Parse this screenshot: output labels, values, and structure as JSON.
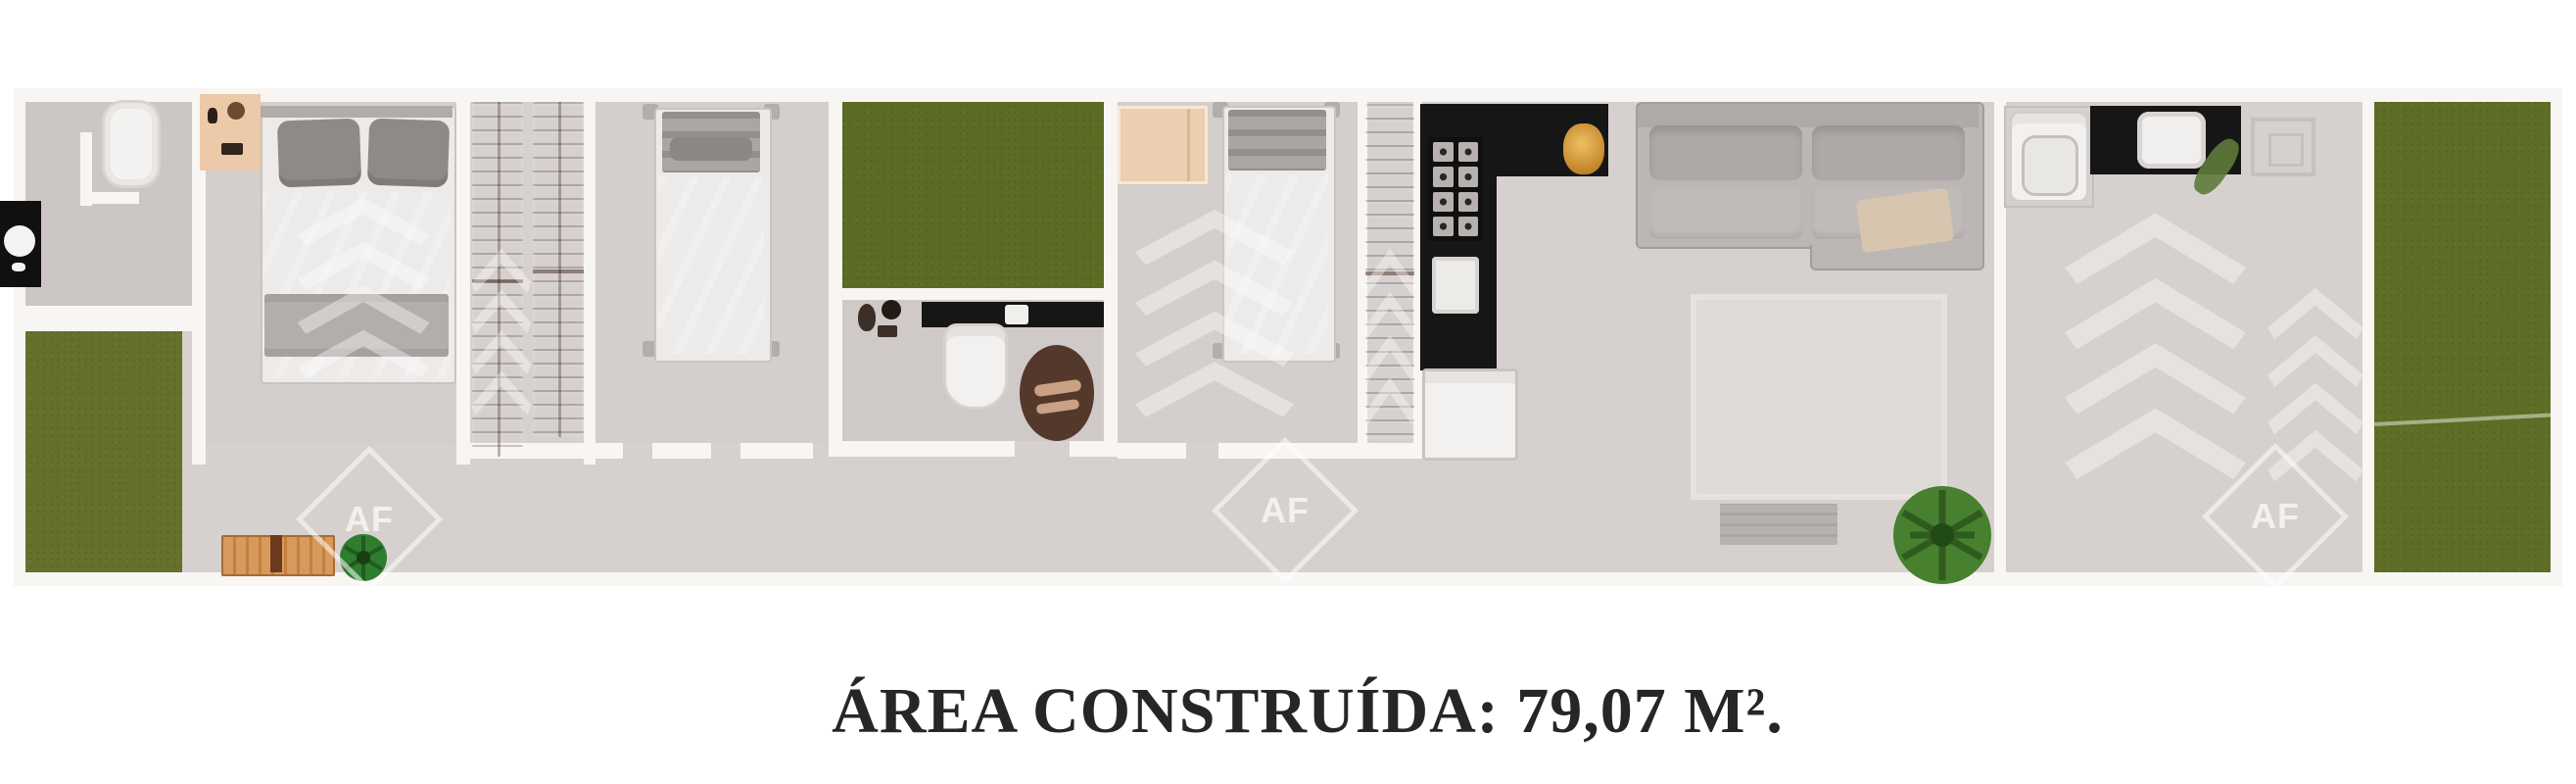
{
  "caption": {
    "text": "ÁREA CONSTRUÍDA: 79,07 M²."
  },
  "watermark": {
    "initials": "AF"
  },
  "colors": {
    "page_bg": "#ffffff",
    "floor": "#d6d1ce",
    "floor_dark": "#ccc7c4",
    "room_floor": "#d4cfcc",
    "wall": "#f8f6f3",
    "grass": "#65702b",
    "courtyard_grass": "#5c6c24",
    "lawn_grass": "#5e6e27",
    "wood": "#9a5130",
    "counter_black": "#161616",
    "sofa": "#bcb7b4",
    "bed_white": "#edebe9",
    "pillow_gray": "#8f8a87",
    "peach": "#eccaa9",
    "tan_box": "#ecceb0",
    "toilet_brown": "#54382b",
    "gold": "#d89333",
    "plant_green": "#47802e",
    "text": "#262626"
  }
}
